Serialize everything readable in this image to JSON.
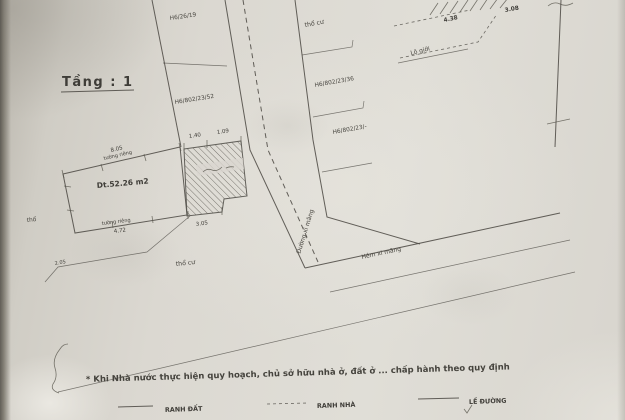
{
  "title": {
    "floor_label": "Tầng : 1"
  },
  "parcels": {
    "area_label": "Dt.52.26 m2",
    "top_left_code": "H6/26/19",
    "left_code": "H6/802/23/52",
    "right_top_type": "thổ cư",
    "right_code_1": "H6/802/23/36",
    "right_code_2": "H6/802/23/-",
    "bottom_type": "thổ cư",
    "left_edge_type": "thổ"
  },
  "roads": {
    "vertical_alley": "Đường xi măng",
    "horizontal_alley": "Hẻm xi măng",
    "road_boundary": "Lộ giới"
  },
  "dimensions": {
    "top_wall_len": "8.05",
    "top_wall_type": "tường riêng",
    "bottom_wall_type": "tường riêng",
    "bottom_wall_len": "4.72",
    "hatch_top_1": "1.40",
    "hatch_top_2": "1.09",
    "hatch_bottom": "3.05",
    "left_bottom": "2.05",
    "top_right_1": "4.38",
    "top_right_2": "3.08"
  },
  "note": "* Khi Nhà nước thực hiện quy hoạch, chủ sở hữu nhà ở, đất ở ...  chấp hành theo quy định",
  "legend": {
    "land_boundary": "RANH ĐẤT",
    "house_boundary": "RANH NHÀ",
    "road_edge": "LỀ ĐƯỜNG"
  },
  "colors": {
    "paper": "#d9d6cf",
    "ink": "#45433e"
  }
}
